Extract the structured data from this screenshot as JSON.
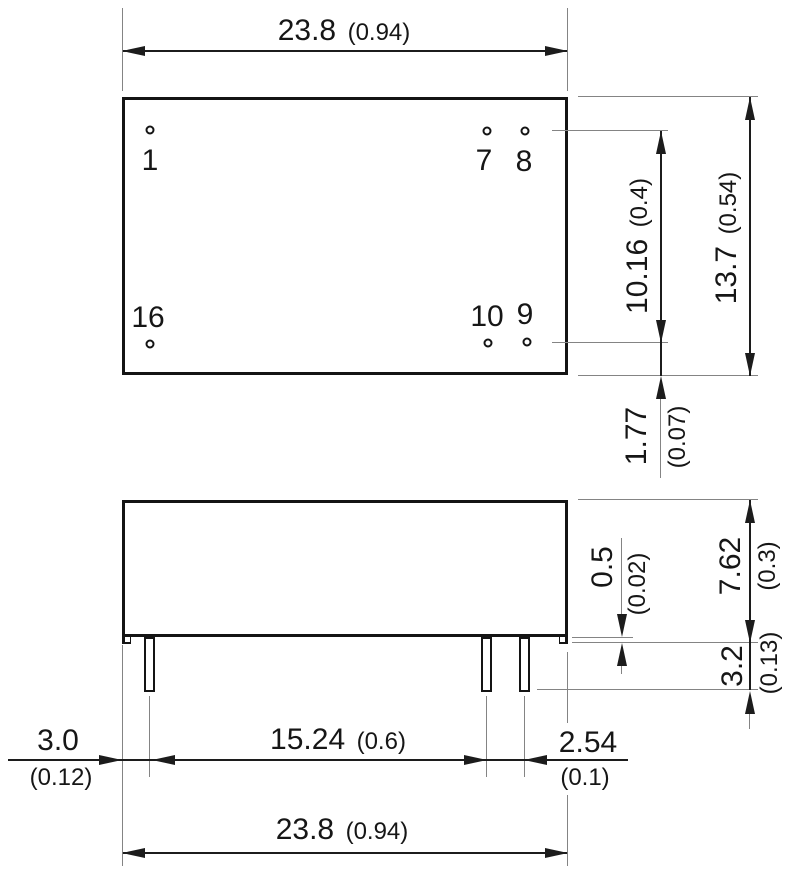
{
  "colors": {
    "outline": "#141414",
    "dimension_line": "#1c1c1c",
    "extension_line": "#848484",
    "background": "#ffffff"
  },
  "top_view": {
    "pins": [
      {
        "id": "1"
      },
      {
        "id": "7"
      },
      {
        "id": "8"
      },
      {
        "id": "16"
      },
      {
        "id": "10"
      },
      {
        "id": "9"
      }
    ]
  },
  "dimensions": {
    "body_length_top": {
      "mm": "23.8",
      "in": "(0.94)"
    },
    "pin_row_span": {
      "mm": "10.16",
      "in": "(0.4)"
    },
    "body_width": {
      "mm": "13.7",
      "in": "(0.54)"
    },
    "pin_row_to_edge": {
      "mm": "1.77",
      "in": "(0.07)"
    },
    "standoff": {
      "mm": "0.5",
      "in": "(0.02)"
    },
    "body_height": {
      "mm": "7.62",
      "in": "(0.3)"
    },
    "pin_length": {
      "mm": "3.2",
      "in": "(0.13)"
    },
    "edge_to_pin": {
      "mm": "3.0",
      "in": "(0.12)"
    },
    "pin_group_span": {
      "mm": "15.24",
      "in": "(0.6)"
    },
    "pin_pitch": {
      "mm": "2.54",
      "in": "(0.1)"
    },
    "body_length_bottom": {
      "mm": "23.8",
      "in": "(0.94)"
    }
  }
}
